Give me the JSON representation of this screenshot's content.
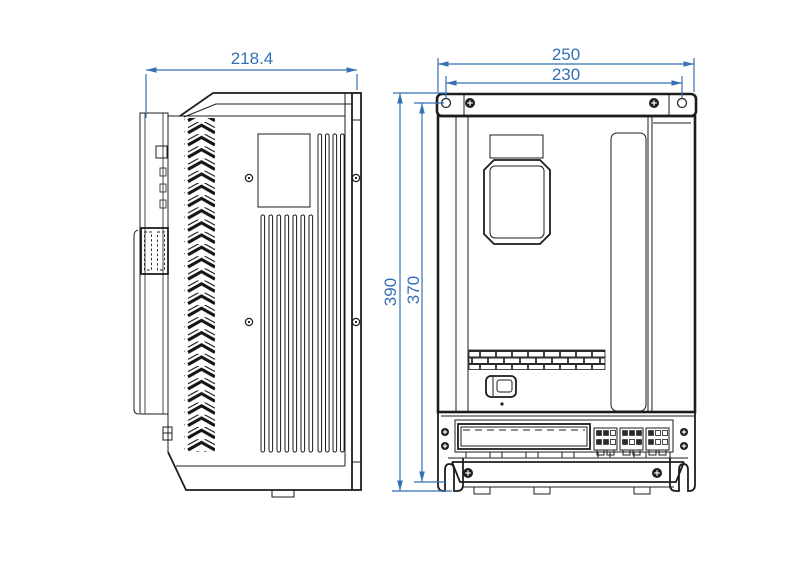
{
  "drawing": {
    "accent_color": "#3470b4",
    "line_color": "#1d1d1d",
    "background_color": "#ffffff",
    "dimensions": {
      "side_depth": "218.4",
      "front_width_outer": "250",
      "front_width_mounting": "230",
      "front_height_outer": "390",
      "front_height_mounting": "370"
    }
  }
}
